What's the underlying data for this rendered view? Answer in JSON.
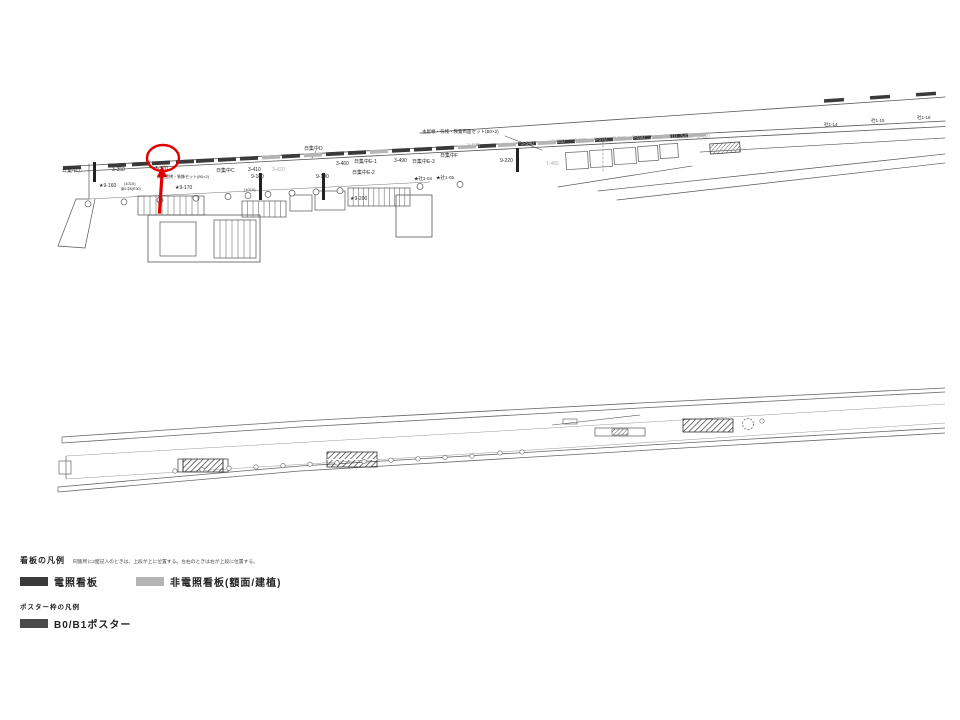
{
  "colors": {
    "highlight": "#e00000",
    "dark_sign": "#3a3a3a",
    "gray_sign": "#b4b4b4",
    "line": "#555555",
    "text": "#2b2b2b",
    "gray_text": "#b0b0b0"
  },
  "legend": {
    "sign_section_title": "看板の凡例",
    "sign_section_note": "同箇所に2面記入のときは、上段が上に位置する。左右のときは右が上段に位置する。",
    "items": [
      {
        "label": "電照看板",
        "swatch": "#3a3a3a"
      },
      {
        "label": "非電照看板(額面/建植)",
        "swatch": "#b4b4b4"
      }
    ],
    "poster_section_title": "ポスター枠の凡例",
    "poster_items": [
      {
        "label": "B0/B1ポスター",
        "swatch": "#4a4a4a"
      }
    ]
  },
  "top_plan": {
    "highlighted_sign": "3-370",
    "labels": [
      {
        "text": "日集中①",
        "x": 62,
        "y": 172
      },
      {
        "text": "3-350",
        "x": 112,
        "y": 171
      },
      {
        "text": "★9-160",
        "x": 99,
        "y": 187
      },
      {
        "text": "3-370",
        "x": 155,
        "y": 170
      },
      {
        "text": "仮設置桟・装飾セット(B0×2)",
        "x": 157,
        "y": 178,
        "size": 4
      },
      {
        "text": "★9-170",
        "x": 175,
        "y": 189
      },
      {
        "text": "(1010)",
        "x": 124,
        "y": 185,
        "size": 4
      },
      {
        "text": "南1中6(R30)",
        "x": 121,
        "y": 190,
        "size": 3.5
      },
      {
        "text": "日集中C",
        "x": 216,
        "y": 172
      },
      {
        "text": "3-410",
        "x": 248,
        "y": 171
      },
      {
        "text": "3-420",
        "x": 272,
        "y": 171,
        "gray": true
      },
      {
        "text": "9-180",
        "x": 251,
        "y": 178
      },
      {
        "text": "9-190",
        "x": 316,
        "y": 178
      },
      {
        "text": "(1010)",
        "x": 244,
        "y": 191,
        "size": 4
      },
      {
        "text": "日集中D",
        "x": 304,
        "y": 150
      },
      {
        "text": "3-460",
        "x": 336,
        "y": 165
      },
      {
        "text": "日集中E-1",
        "x": 354,
        "y": 163
      },
      {
        "text": "日集中E-2",
        "x": 352,
        "y": 174
      },
      {
        "text": "3-490",
        "x": 394,
        "y": 162
      },
      {
        "text": "日集中E-3",
        "x": 412,
        "y": 163
      },
      {
        "text": "日集中F",
        "x": 440,
        "y": 157
      },
      {
        "text": "★社1-04",
        "x": 414,
        "y": 180,
        "size": 4.5
      },
      {
        "text": "★社1-05",
        "x": 436,
        "y": 179,
        "size": 4.5
      },
      {
        "text": "★9-200",
        "x": 350,
        "y": 200
      },
      {
        "text": "主屋根・背桟・鞍置両面セット(B0×2)",
        "x": 422,
        "y": 133,
        "size": 4.5
      },
      {
        "text": "9-220",
        "x": 500,
        "y": 162
      },
      {
        "text": "1-480",
        "x": 546,
        "y": 165,
        "gray": true
      },
      {
        "text": "3-520",
        "x": 467,
        "y": 147,
        "gray": true
      },
      {
        "text": "3-540",
        "x": 521,
        "y": 145,
        "gray": true
      },
      {
        "text": "3-550",
        "x": 552,
        "y": 143,
        "gray": true
      },
      {
        "text": "3-560",
        "x": 574,
        "y": 142,
        "gray": true
      },
      {
        "text": "3-570",
        "x": 594,
        "y": 141,
        "gray": true
      },
      {
        "text": "3-580",
        "x": 613,
        "y": 140,
        "gray": true
      },
      {
        "text": "3-590",
        "x": 632,
        "y": 139,
        "gray": true
      },
      {
        "text": "3-600",
        "x": 650,
        "y": 139,
        "gray": true
      },
      {
        "text": "3-610",
        "x": 664,
        "y": 138,
        "gray": true
      },
      {
        "text": "3-620",
        "x": 680,
        "y": 138,
        "gray": true
      },
      {
        "text": "3-630",
        "x": 697,
        "y": 138,
        "gray": true
      },
      {
        "text": "社1-14",
        "x": 824,
        "y": 126,
        "size": 4.5
      },
      {
        "text": "社1-15",
        "x": 871,
        "y": 122,
        "size": 4.5
      },
      {
        "text": "社1-16",
        "x": 917,
        "y": 119,
        "size": 4.5
      }
    ],
    "sign_bars": [
      {
        "x": 63,
        "shade": "dark"
      },
      {
        "x": 108,
        "shade": "dark"
      },
      {
        "x": 132,
        "shade": "dark"
      },
      {
        "x": 152,
        "shade": "dark"
      },
      {
        "x": 176,
        "shade": "dark"
      },
      {
        "x": 196,
        "shade": "dark"
      },
      {
        "x": 218,
        "shade": "dark"
      },
      {
        "x": 240,
        "shade": "dark"
      },
      {
        "x": 262,
        "shade": "gray"
      },
      {
        "x": 282,
        "shade": "dark"
      },
      {
        "x": 304,
        "shade": "gray"
      },
      {
        "x": 326,
        "shade": "dark"
      },
      {
        "x": 348,
        "shade": "dark"
      },
      {
        "x": 370,
        "shade": "gray"
      },
      {
        "x": 392,
        "shade": "dark"
      },
      {
        "x": 414,
        "shade": "dark"
      },
      {
        "x": 436,
        "shade": "dark"
      },
      {
        "x": 458,
        "shade": "gray"
      },
      {
        "x": 478,
        "shade": "dark"
      },
      {
        "x": 498,
        "shade": "gray"
      },
      {
        "x": 518,
        "shade": "dark"
      },
      {
        "x": 538,
        "shade": "gray"
      },
      {
        "x": 557,
        "shade": "dark"
      },
      {
        "x": 576,
        "shade": "gray"
      },
      {
        "x": 595,
        "shade": "dark"
      },
      {
        "x": 614,
        "shade": "gray"
      },
      {
        "x": 633,
        "shade": "dark"
      },
      {
        "x": 652,
        "shade": "gray"
      },
      {
        "x": 670,
        "shade": "dark"
      },
      {
        "x": 688,
        "shade": "gray"
      }
    ],
    "upper_sign_bars": [
      {
        "x": 824
      },
      {
        "x": 870
      },
      {
        "x": 916
      }
    ],
    "vertical_signs": [
      {
        "x": 93,
        "y": 162,
        "h": 20
      },
      {
        "x": 259,
        "y": 173,
        "h": 27
      },
      {
        "x": 322,
        "y": 173,
        "h": 27
      },
      {
        "x": 516,
        "y": 148,
        "h": 24
      }
    ]
  },
  "bottom_plan": {
    "labels": []
  }
}
